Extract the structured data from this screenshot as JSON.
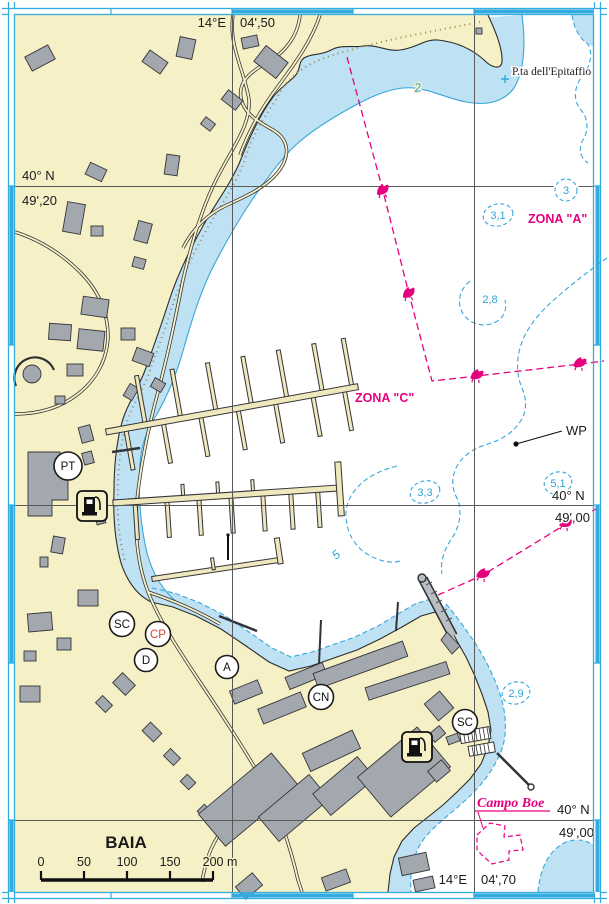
{
  "chart": {
    "type": "nautical-chart",
    "title": "BAIA",
    "labels": {
      "headland": "P.ta dell'Epitaffio",
      "zona_a": "ZONA \"A\"",
      "zona_c": "ZONA \"C\"",
      "waypoint": "WP",
      "campo_boe": "Campo Boe",
      "town": "BAIA"
    },
    "graticule": {
      "lon_top": {
        "deg": "14°E",
        "min": "04',50"
      },
      "lon_bottom": {
        "deg": "14°E",
        "min": "04',70"
      },
      "lat_left": {
        "deg": "40° N",
        "min": "49',20"
      },
      "lat_right_mid": {
        "deg": "40° N",
        "min": "49',00"
      },
      "lat_right_bottom": {
        "deg": "40° N",
        "min": "49',00"
      }
    },
    "soundings": {
      "s_3": "3",
      "s_3_1": "3,1",
      "s_2_8": "2,8",
      "s_3_3": "3,3",
      "s_5_1": "5,1",
      "s_2_9": "2,9"
    },
    "contour_labels": {
      "c2": "2",
      "c5": "5"
    },
    "stations": {
      "pt": "PT",
      "sc_west": "SC",
      "cp": "CP",
      "d": "D",
      "a": "A",
      "cn": "CN",
      "sc_east": "SC"
    },
    "scale_bar": {
      "t0": "0",
      "t50": "50",
      "t100": "100",
      "t150": "150",
      "t200": "200 m"
    },
    "colors": {
      "land": "#F6F0C6",
      "shallow_water": "#BEE1F3",
      "building": "#A2A8AD",
      "contour_cyan": "#35A7DA",
      "magenta": "#E6007E",
      "station_red": "#E04030",
      "grid": "#595959",
      "frame": "#33ABDE"
    }
  }
}
